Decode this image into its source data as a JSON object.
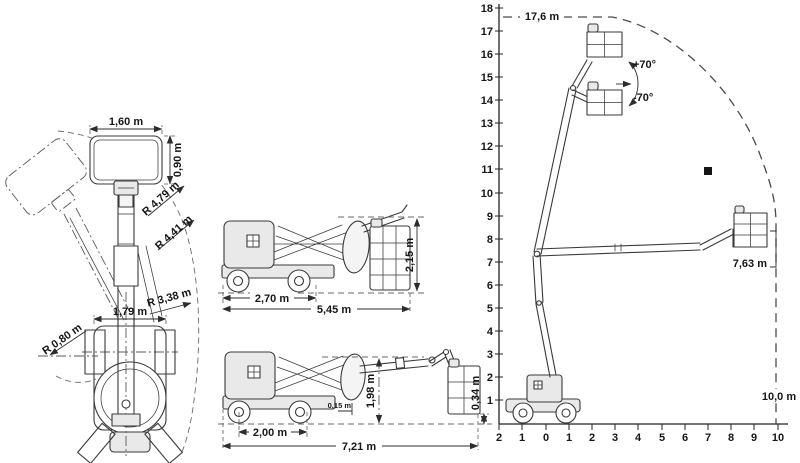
{
  "plan_view": {
    "platform_width": "1,60 m",
    "platform_depth": "0,90 m",
    "radius_outer": "R 4,79 m",
    "radius_basket": "R 4,41 m",
    "radius_tail": "R 3,38 m",
    "chassis_width": "1,79 m",
    "radius_inner": "R 0,80 m"
  },
  "stowed_view": {
    "wheelbase": "2,70 m",
    "overall_length": "5,45 m",
    "overall_height": "2,15 m"
  },
  "working_view": {
    "wheelbase": "2,00 m",
    "overall_length": "7,21 m",
    "ground_clearance": "0,15 m",
    "boom_rest_height": "1,98 m",
    "basket_floor_height": "0,34 m"
  },
  "chart": {
    "y_ticks": [
      "18",
      "17",
      "16",
      "15",
      "14",
      "13",
      "12",
      "11",
      "10",
      "9",
      "8",
      "7",
      "6",
      "5",
      "4",
      "3",
      "2",
      "1"
    ],
    "x_ticks": [
      "2",
      "1",
      "0",
      "1",
      "2",
      "3",
      "4",
      "5",
      "6",
      "7",
      "8",
      "9",
      "10"
    ],
    "max_height_label": "17,6 m",
    "jib_up_label": "+70°",
    "jib_down_label": "-70°",
    "basket_height_label": "7,63 m",
    "outreach_label": "10,0 m"
  },
  "chart_data": {
    "type": "line",
    "x_range_m": [
      -2,
      10
    ],
    "y_range_m": [
      0,
      18
    ],
    "x_tick_labels": [
      "2",
      "1",
      "0",
      "1",
      "2",
      "3",
      "4",
      "5",
      "6",
      "7",
      "8",
      "9",
      "10"
    ],
    "y_tick_values": [
      1,
      2,
      3,
      4,
      5,
      6,
      7,
      8,
      9,
      10,
      11,
      12,
      13,
      14,
      15,
      16,
      17,
      18
    ],
    "envelope_outline_m": [
      [
        -2,
        17.6
      ],
      [
        3,
        17.6
      ],
      [
        6,
        16.2
      ],
      [
        8,
        13.5
      ],
      [
        9.5,
        10.2
      ],
      [
        10,
        8.8
      ],
      [
        10,
        0
      ]
    ],
    "max_height_m": 17.6,
    "max_outreach_m": 10.0,
    "horizontal_basket_floor_height_m": 7.63,
    "jib_articulation_deg": [
      70,
      -70
    ],
    "point_marker_m": [
      7,
      11
    ],
    "grid": false,
    "legend": false
  }
}
